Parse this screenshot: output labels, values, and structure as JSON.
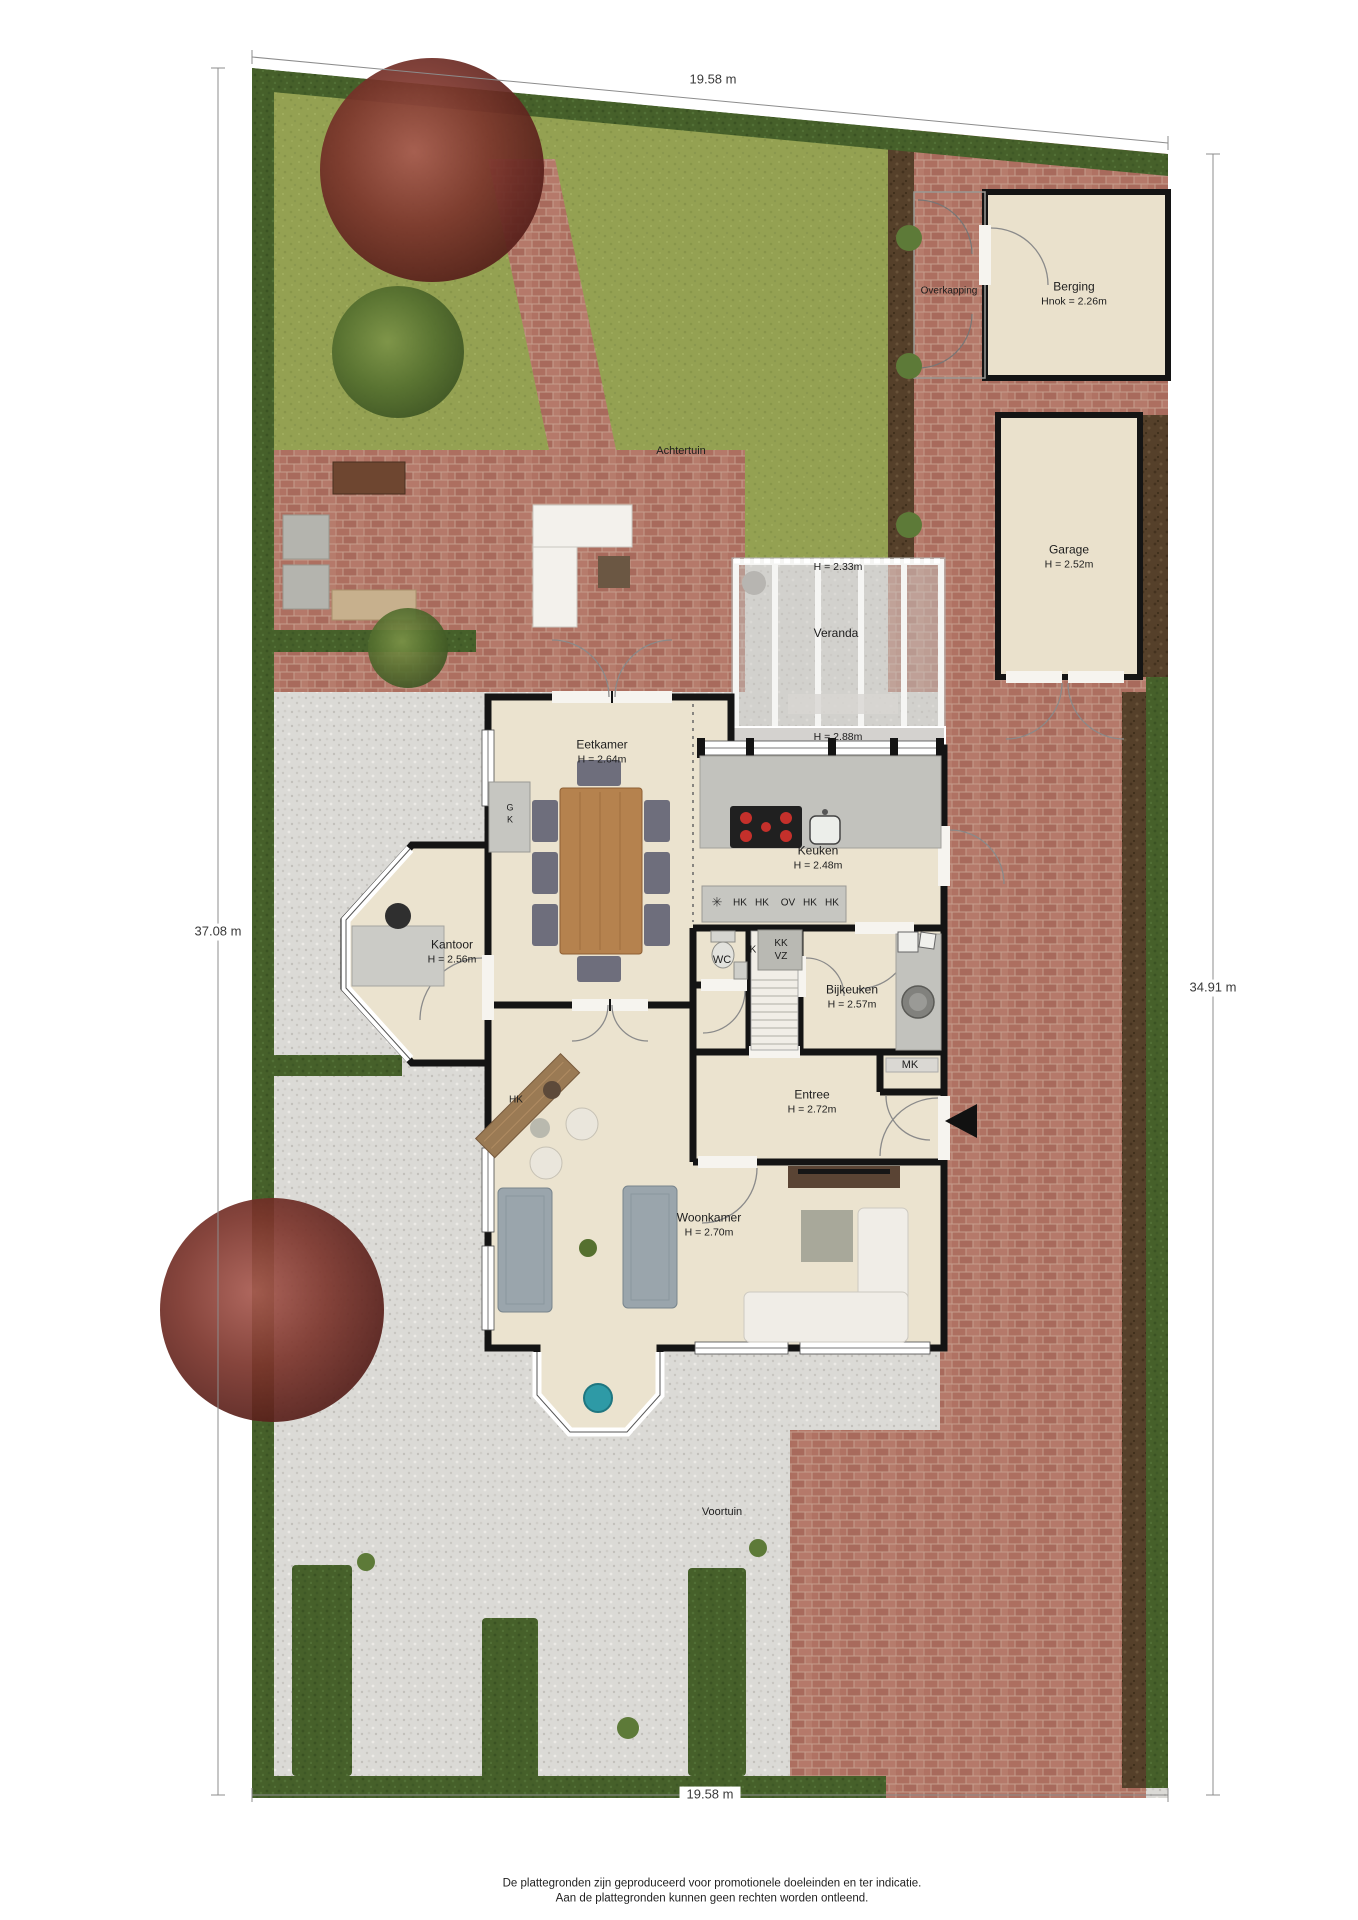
{
  "dimensions": {
    "top": "19.58 m",
    "bottom": "19.58 m",
    "left": "37.08 m",
    "right": "34.91 m"
  },
  "garden": {
    "back": "Achtertuin",
    "front": "Voortuin"
  },
  "structures": {
    "overkapping": {
      "name": "Overkapping"
    },
    "berging": {
      "name": "Berging",
      "height": "Hnok = 2.26m"
    },
    "garage": {
      "name": "Garage",
      "height": "H = 2.52m"
    },
    "veranda": {
      "name": "Veranda",
      "height_upper": "H = 2.33m",
      "height_lower": "H = 2.88m"
    }
  },
  "rooms": {
    "eetkamer": {
      "name": "Eetkamer",
      "height": "H = 2.64m"
    },
    "keuken": {
      "name": "Keuken",
      "height": "H = 2.48m"
    },
    "kantoor": {
      "name": "Kantoor",
      "height": "H = 2.56m"
    },
    "wc": {
      "name": "WC"
    },
    "bijkeuken": {
      "name": "Bijkeuken",
      "height": "H = 2.57m"
    },
    "entree": {
      "name": "Entree",
      "height": "H = 2.72m"
    },
    "woonkamer": {
      "name": "Woonkamer",
      "height": "H = 2.70m"
    }
  },
  "closets": {
    "appliance_row": [
      "HK",
      "HK",
      "OV",
      "HK",
      "HK"
    ],
    "k": "K",
    "kk": "KK",
    "vz": "VZ",
    "mk": "MK",
    "hall_cabinet": "HK",
    "g": "G",
    "g_k": "K"
  },
  "icons": {
    "ventilation": "✳"
  },
  "footer": {
    "line1": "De plattegronden zijn geproduceerd voor promotionele doeleinden en ter indicatie.",
    "line2": "Aan de plattegronden kunnen geen rechten worden ontleend."
  },
  "colors": {
    "grass": "#94a152",
    "hedge": "#46602a",
    "brick": "#b07468",
    "gravel": "#dbdad6",
    "dirt": "#55402a",
    "floor": "#ebe3cf",
    "wall": "#141414",
    "teal_chair": "#2e9aa6"
  }
}
